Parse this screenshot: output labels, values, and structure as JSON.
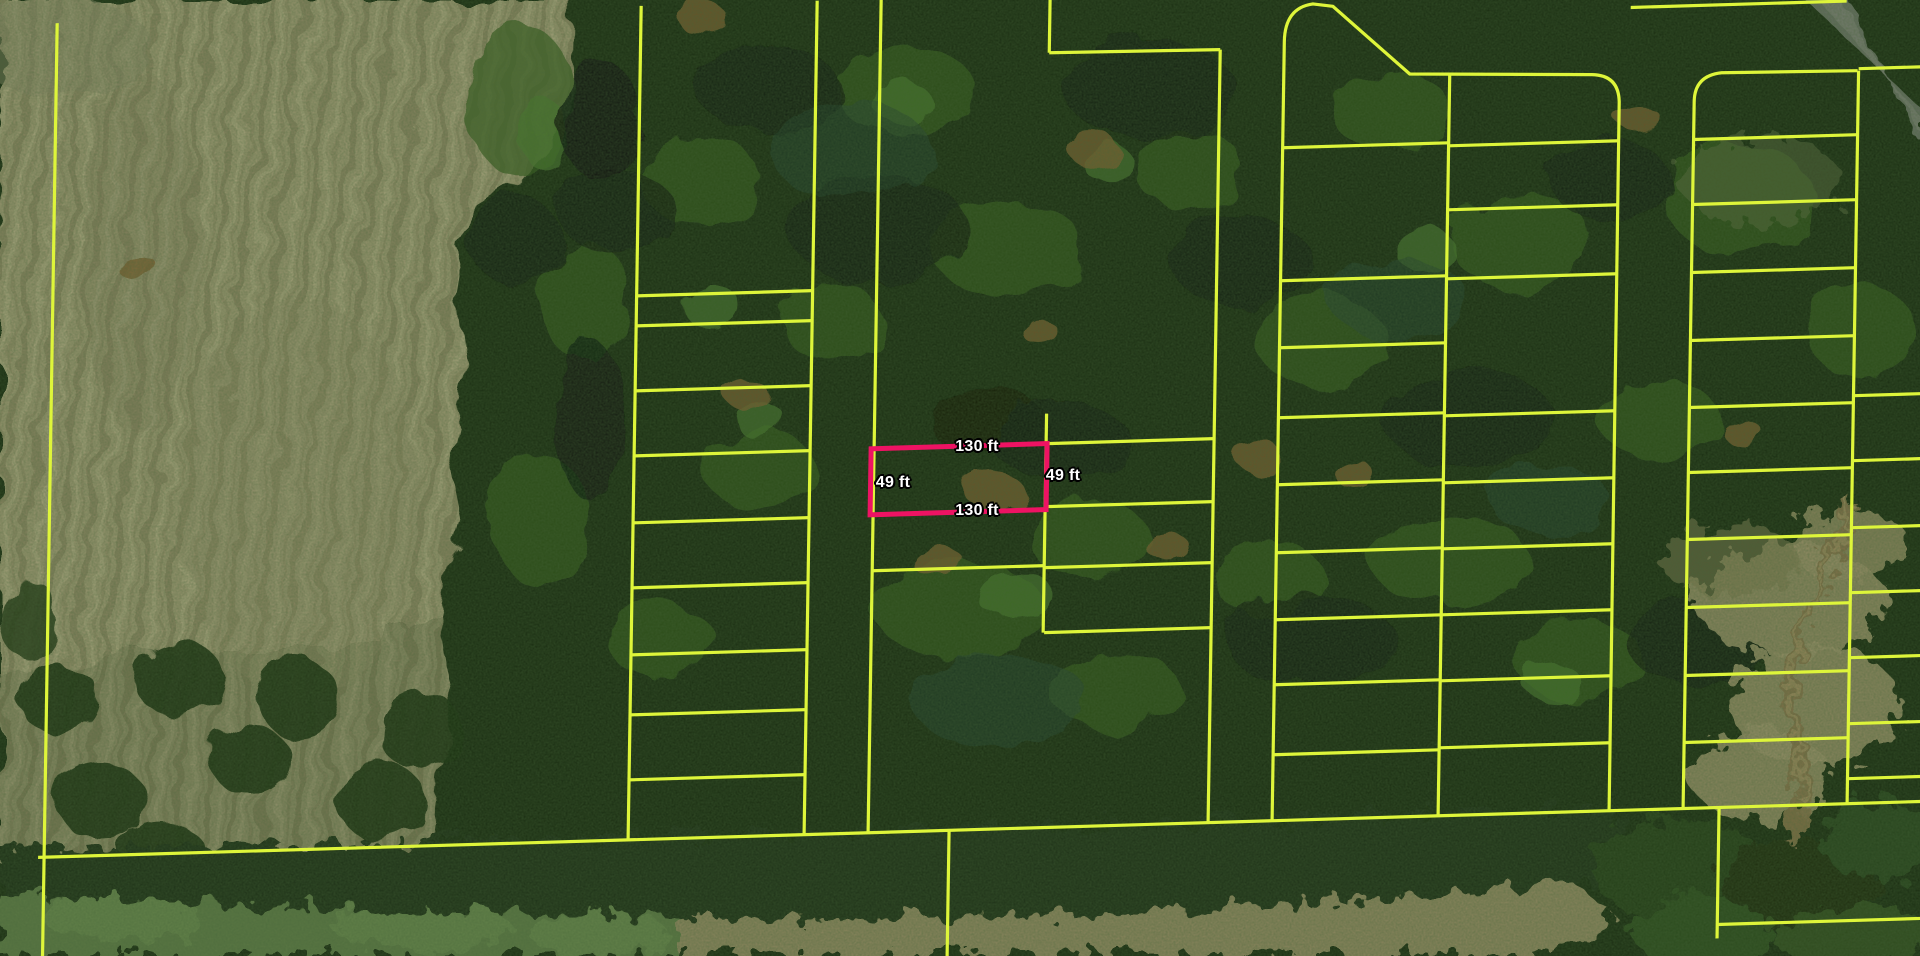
{
  "map": {
    "colors": {
      "parcel_line": "#def53a",
      "highlight": "#ee1363",
      "label_text": "#ffffff",
      "label_outline": "#000000"
    },
    "highlight_parcel": {
      "x": 871,
      "y": 445,
      "width": 176,
      "height": 66,
      "dimensions": {
        "top": "130 ft",
        "right": "49 ft",
        "bottom": "130 ft",
        "left": "49 ft"
      }
    },
    "labels": [
      {
        "text": "130 ft",
        "x": 977,
        "y": 447
      },
      {
        "text": "49 ft",
        "x": 893,
        "y": 483
      },
      {
        "text": "49 ft",
        "x": 1063,
        "y": 476
      },
      {
        "text": "130 ft",
        "x": 977,
        "y": 511
      }
    ],
    "parcel_lines": [
      [
        50,
        -5,
        50,
        960
      ],
      [
        44,
        829,
        1930,
        829
      ],
      [
        955,
        829,
        955,
        960
      ],
      [
        634,
        -5,
        634,
        829
      ],
      [
        810,
        -5,
        810,
        829
      ],
      [
        634,
        285,
        810,
        285
      ],
      [
        634,
        315,
        810,
        315
      ],
      [
        634,
        380,
        810,
        380
      ],
      [
        634,
        445,
        810,
        445
      ],
      [
        634,
        512,
        810,
        512
      ],
      [
        634,
        577,
        810,
        577
      ],
      [
        634,
        644,
        810,
        644
      ],
      [
        634,
        704,
        810,
        704
      ],
      [
        634,
        769,
        810,
        769
      ],
      [
        874,
        -5,
        874,
        829
      ],
      [
        1043,
        -5,
        1043,
        54
      ],
      [
        1043,
        54,
        1214,
        56
      ],
      [
        1214,
        56,
        1214,
        829
      ],
      [
        1046,
        415,
        1046,
        634
      ],
      [
        874,
        567,
        1047,
        567
      ],
      [
        1047,
        445,
        1214,
        445
      ],
      [
        1047,
        508,
        1214,
        508
      ],
      [
        1047,
        569,
        1214,
        569
      ],
      [
        1047,
        634,
        1214,
        634
      ],
      [
        1444,
        88,
        1444,
        829
      ],
      [
        1278,
        156,
        1444,
        156
      ],
      [
        1278,
        289,
        1444,
        289
      ],
      [
        1278,
        356,
        1444,
        356
      ],
      [
        1278,
        426,
        1444,
        426
      ],
      [
        1278,
        493,
        1444,
        493
      ],
      [
        1278,
        561,
        1444,
        561
      ],
      [
        1278,
        628,
        1444,
        628
      ],
      [
        1278,
        693,
        1444,
        693
      ],
      [
        1278,
        763,
        1444,
        763
      ],
      [
        1444,
        159,
        1615,
        159
      ],
      [
        1444,
        223,
        1615,
        223
      ],
      [
        1444,
        292,
        1615,
        292
      ],
      [
        1444,
        429,
        1615,
        429
      ],
      [
        1444,
        496,
        1615,
        496
      ],
      [
        1444,
        562,
        1615,
        562
      ],
      [
        1444,
        628,
        1615,
        628
      ],
      [
        1444,
        694,
        1615,
        694
      ],
      [
        1444,
        761,
        1615,
        761
      ],
      [
        1853,
        96,
        1853,
        829
      ],
      [
        1689,
        160,
        1853,
        160
      ],
      [
        1689,
        225,
        1853,
        225
      ],
      [
        1689,
        293,
        1853,
        293
      ],
      [
        1689,
        361,
        1853,
        361
      ],
      [
        1689,
        428,
        1853,
        428
      ],
      [
        1689,
        493,
        1853,
        493
      ],
      [
        1689,
        560,
        1853,
        560
      ],
      [
        1689,
        628,
        1853,
        628
      ],
      [
        1689,
        696,
        1853,
        696
      ],
      [
        1689,
        763,
        1853,
        763
      ],
      [
        1853,
        94,
        1930,
        94
      ],
      [
        1853,
        421,
        1930,
        421
      ],
      [
        1853,
        486,
        1930,
        486
      ],
      [
        1853,
        553,
        1930,
        553
      ],
      [
        1853,
        618,
        1930,
        618
      ],
      [
        1853,
        683,
        1930,
        683
      ],
      [
        1853,
        749,
        1930,
        749
      ],
      [
        1853,
        804,
        1930,
        804
      ],
      [
        1624,
        26,
        1840,
        26
      ],
      [
        1725,
        829,
        1725,
        960
      ],
      [
        1725,
        946,
        1930,
        946
      ]
    ],
    "parcel_paths": [
      "M1278,829 L1278,50 Q1278,16 1306,13 L1326,16 L1404,86 L1586,92 Q1613,93 1614,120 L1615,829",
      "M1689,829 L1689,122 Q1689,96 1716,94 L1852,96"
    ]
  }
}
